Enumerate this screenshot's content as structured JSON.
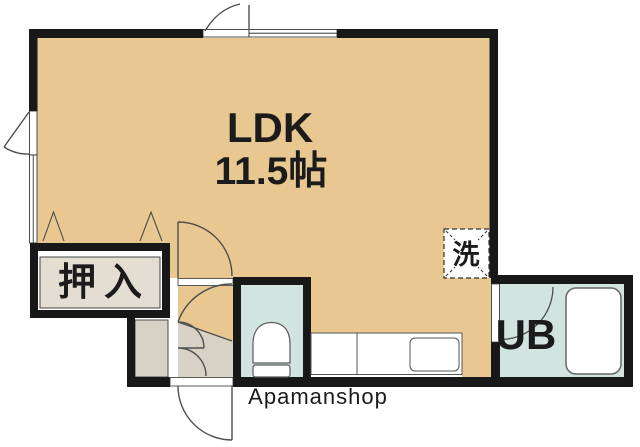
{
  "floorplan": {
    "rooms": {
      "ldk": {
        "name": "LDK",
        "size": "11.5帖"
      },
      "closet": {
        "label": "押入"
      },
      "bath": {
        "label": "UB"
      },
      "laundry": {
        "label": "洗"
      }
    },
    "watermark": "Apamanshop",
    "colors": {
      "floor": "#e8c890",
      "entrance": "#d7d2c5",
      "wet_room": "#d2e4e0",
      "closet_floor": "#e3ded1",
      "wall": "#181818",
      "fixture_line": "#5a5a5a",
      "door_line": "#4f4f4f",
      "watermark_text": "#8c8c8c"
    }
  }
}
